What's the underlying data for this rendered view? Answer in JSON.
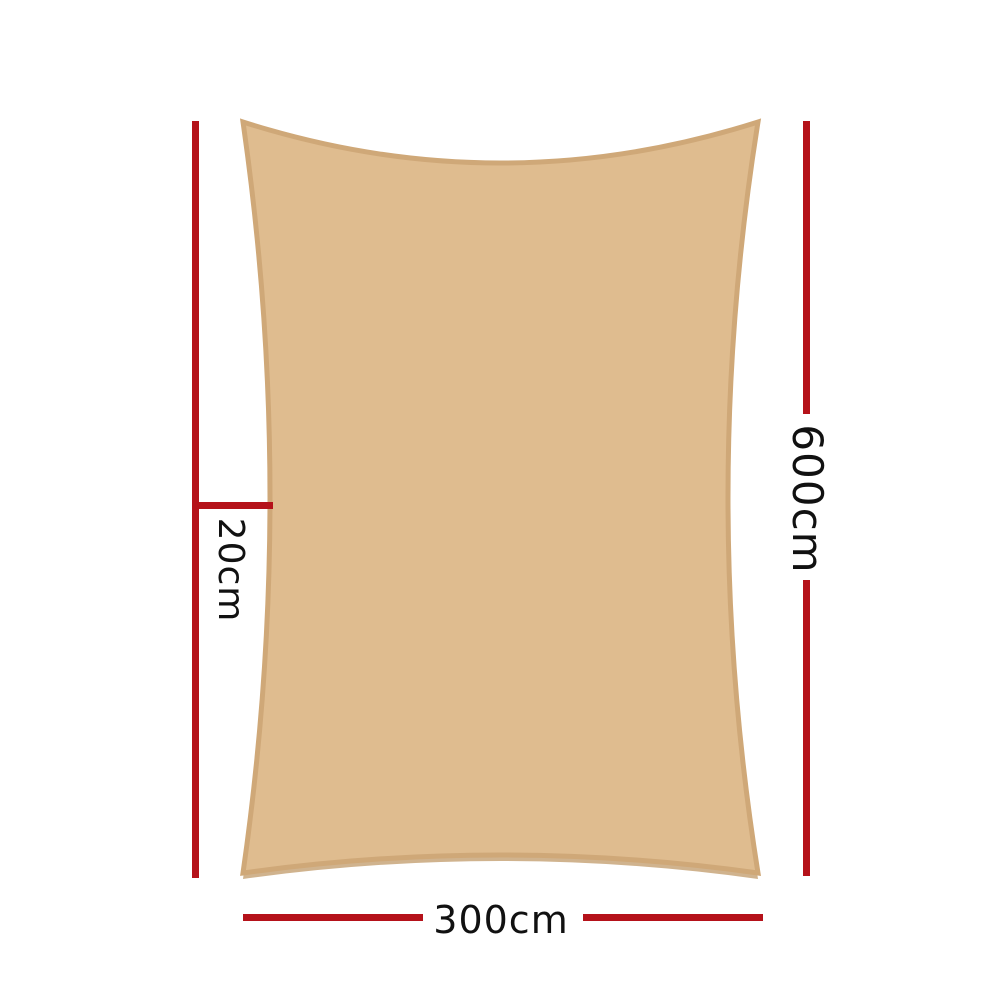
{
  "page": {
    "background": "#ffffff"
  },
  "diagram": {
    "subject": "rectangle-shade-sail",
    "sail_colors": {
      "fill": "#dfbc8f",
      "border": "#cfa878",
      "shadow": "#c8a67a"
    },
    "dimension_line_color": "#b5121a",
    "label_color": "#111111",
    "dimensions": {
      "height": {
        "label": "600cm",
        "side": "right",
        "orientation": "vertical"
      },
      "width": {
        "label": "300cm",
        "side": "bottom",
        "orientation": "horizontal"
      },
      "edge_offset": {
        "label": "20cm",
        "side": "left",
        "orientation": "vertical"
      }
    }
  }
}
